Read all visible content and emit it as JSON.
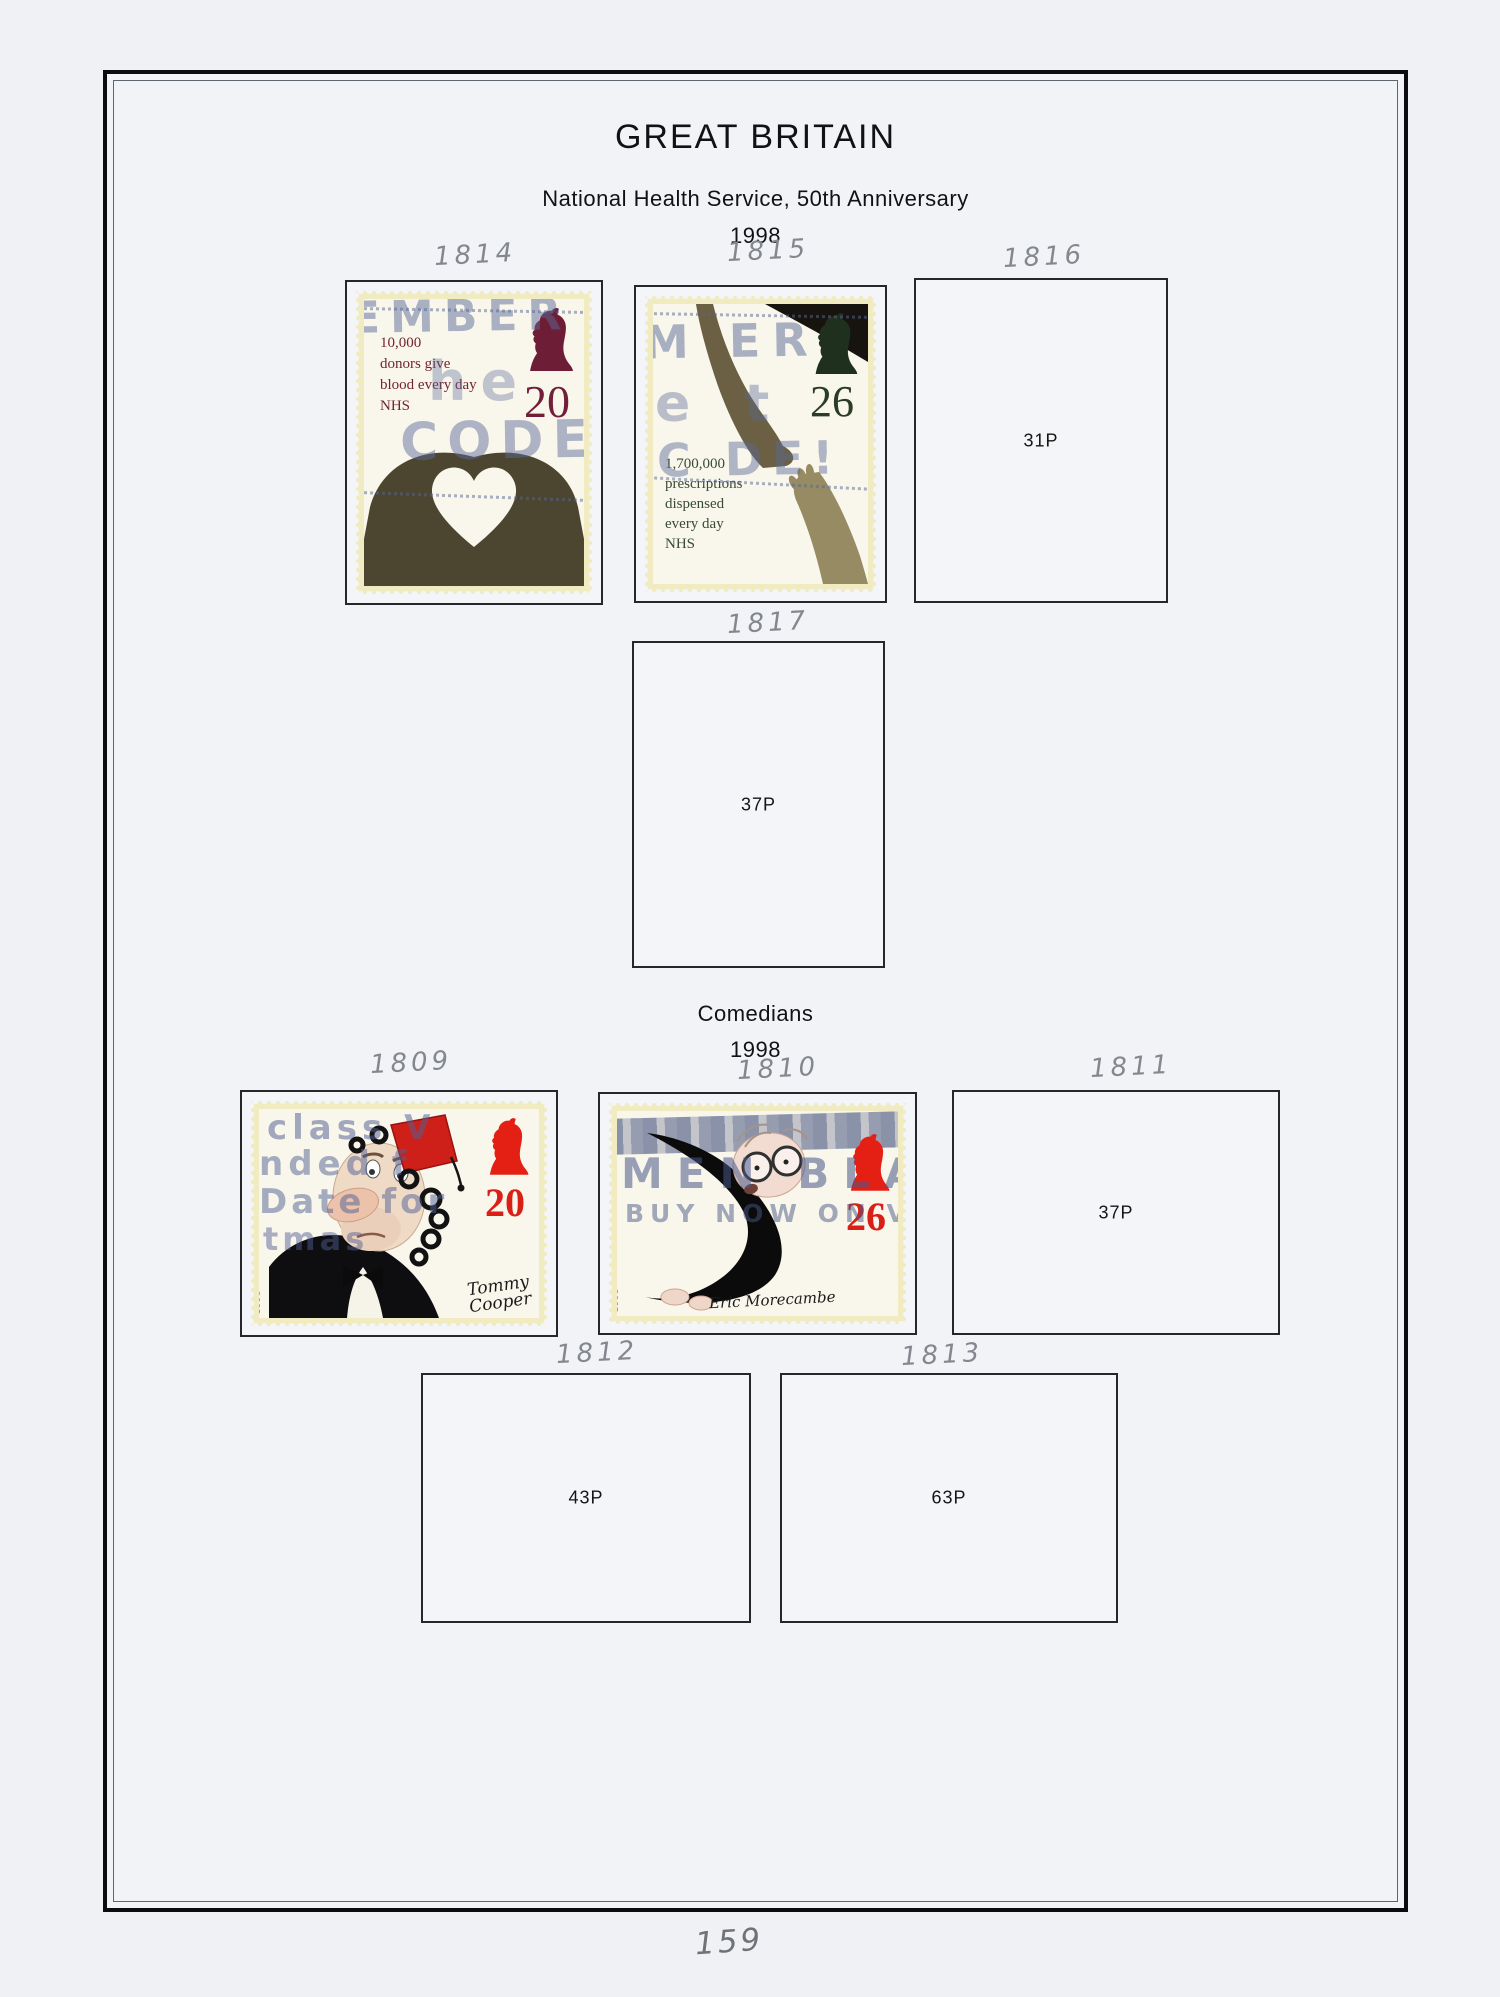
{
  "page": {
    "country": "GREAT BRITAIN",
    "page_number": "159"
  },
  "sections": {
    "nhs": {
      "title": "National Health Service, 50th Anniversary",
      "year": "1998"
    },
    "comedians": {
      "title": "Comedians",
      "year": "1998"
    }
  },
  "stamps": {
    "s1814": {
      "catalog": "1814",
      "denom": "20",
      "caption": [
        "10,000",
        "donors give",
        "blood every day",
        "NHS"
      ],
      "postmark": [
        "EMBER",
        "he",
        "CODE!"
      ]
    },
    "s1815": {
      "catalog": "1815",
      "denom": "26",
      "caption": [
        "1,700,000",
        "prescriptions",
        "dispensed",
        "every day",
        "NHS"
      ],
      "postmark": [
        "M ER",
        "e t",
        "C DE!"
      ]
    },
    "s1809": {
      "catalog": "1809",
      "denom": "20",
      "postmark": [
        "class V",
        "nded f",
        "Date for",
        "tmas"
      ],
      "signature": [
        "Tommy",
        "Cooper"
      ],
      "edge_year": "1998"
    },
    "s1810": {
      "catalog": "1810",
      "denom": "26",
      "postmark": [
        "MEN BLA",
        "BUY NOW ON VE"
      ],
      "signature": [
        "Eric Morecambe"
      ],
      "edge_year": "1998"
    }
  },
  "slots": {
    "s1816": {
      "catalog": "1816",
      "value": "31P"
    },
    "s1817": {
      "catalog": "1817",
      "value": "37P"
    },
    "s1811": {
      "catalog": "1811",
      "value": "37P"
    },
    "s1812": {
      "catalog": "1812",
      "value": "43P"
    },
    "s1813": {
      "catalog": "1813",
      "value": "63P"
    }
  },
  "colors": {
    "postmark_blue": "#5a6a96",
    "nhs_20p_maroon": "#72203a",
    "nhs_26p_green": "#2c3d24",
    "comedian_red": "#da1f17",
    "stamp_cream_edge": "#f1ebc2",
    "pencil_gray": "#84888e",
    "page_background": "#eff1f4"
  }
}
